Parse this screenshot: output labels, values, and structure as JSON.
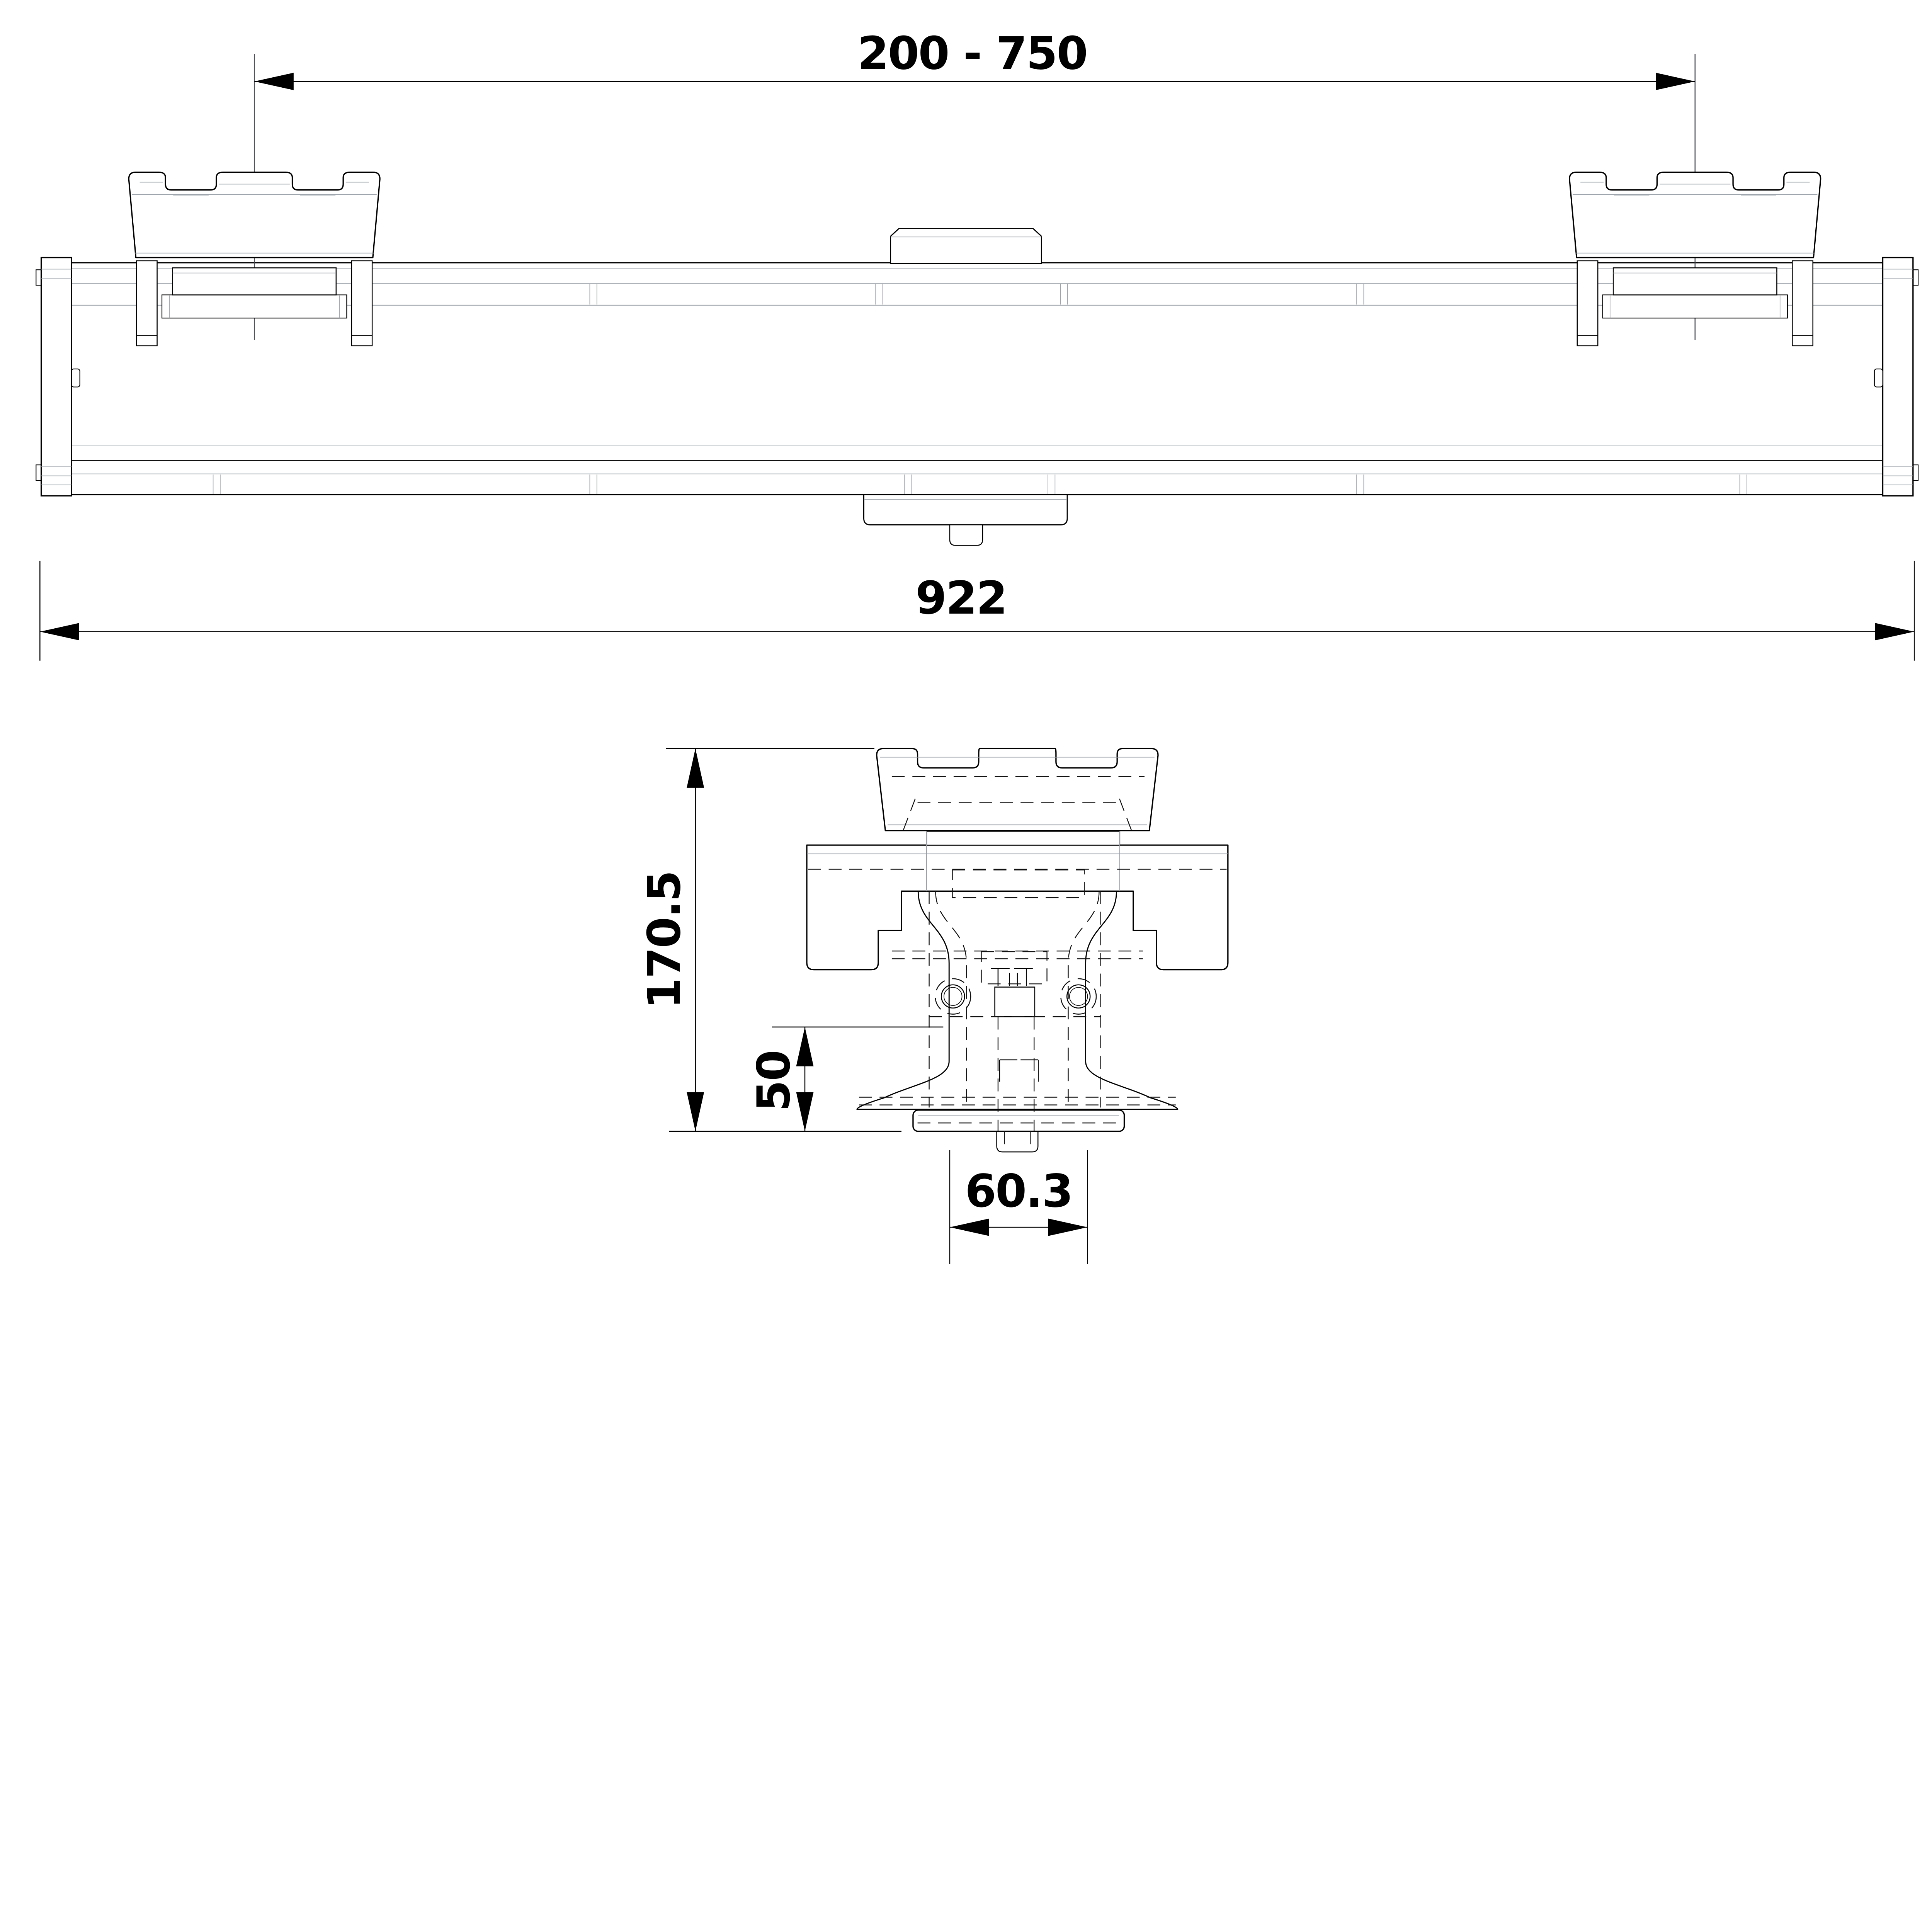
{
  "page": {
    "background": "#ffffff"
  },
  "drawing": {
    "kind": "cad-dimension-drawing",
    "dimensions": {
      "bracket_spacing": {
        "label": "200 - 750"
      },
      "overall_length": {
        "label": "922"
      },
      "overall_height": {
        "label": "170.5"
      },
      "mount_height": {
        "label": "50"
      },
      "pipe_width": {
        "label": "60.3"
      }
    },
    "colors": {
      "outline": "#000000",
      "secondary": "#9aa0a8",
      "centerline": "#43464b",
      "background": "#ffffff"
    }
  }
}
